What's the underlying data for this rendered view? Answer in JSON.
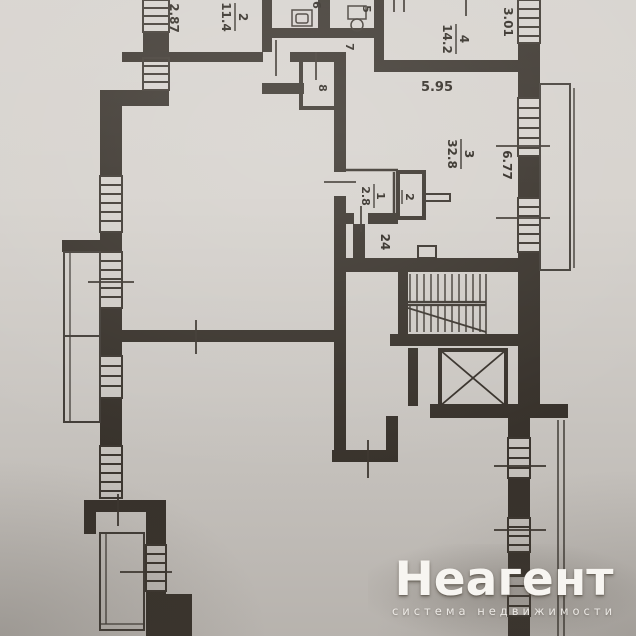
{
  "watermark": {
    "brand": "Неагент",
    "tagline": "система недвижимости"
  },
  "floorplan": {
    "rooms": [
      {
        "number": "2",
        "area": "11.4"
      },
      {
        "number": "4",
        "area": "14.2"
      },
      {
        "number": "3",
        "area": "32.8"
      },
      {
        "number": "1",
        "area": "2.8"
      }
    ],
    "room_numbers": {
      "r5": "5",
      "r6": "6",
      "r7": "7",
      "r8": "8"
    },
    "shaft_label": "2",
    "hall_label": "24",
    "dimensions": {
      "left_top": "2.87",
      "right_top": "3.01",
      "mid_width": "5.95",
      "right_mid": "6.77"
    }
  },
  "colors": {
    "paper": "#d6d2cd",
    "ink": "#3a342d",
    "watermark_text": "#f7f5f1"
  }
}
